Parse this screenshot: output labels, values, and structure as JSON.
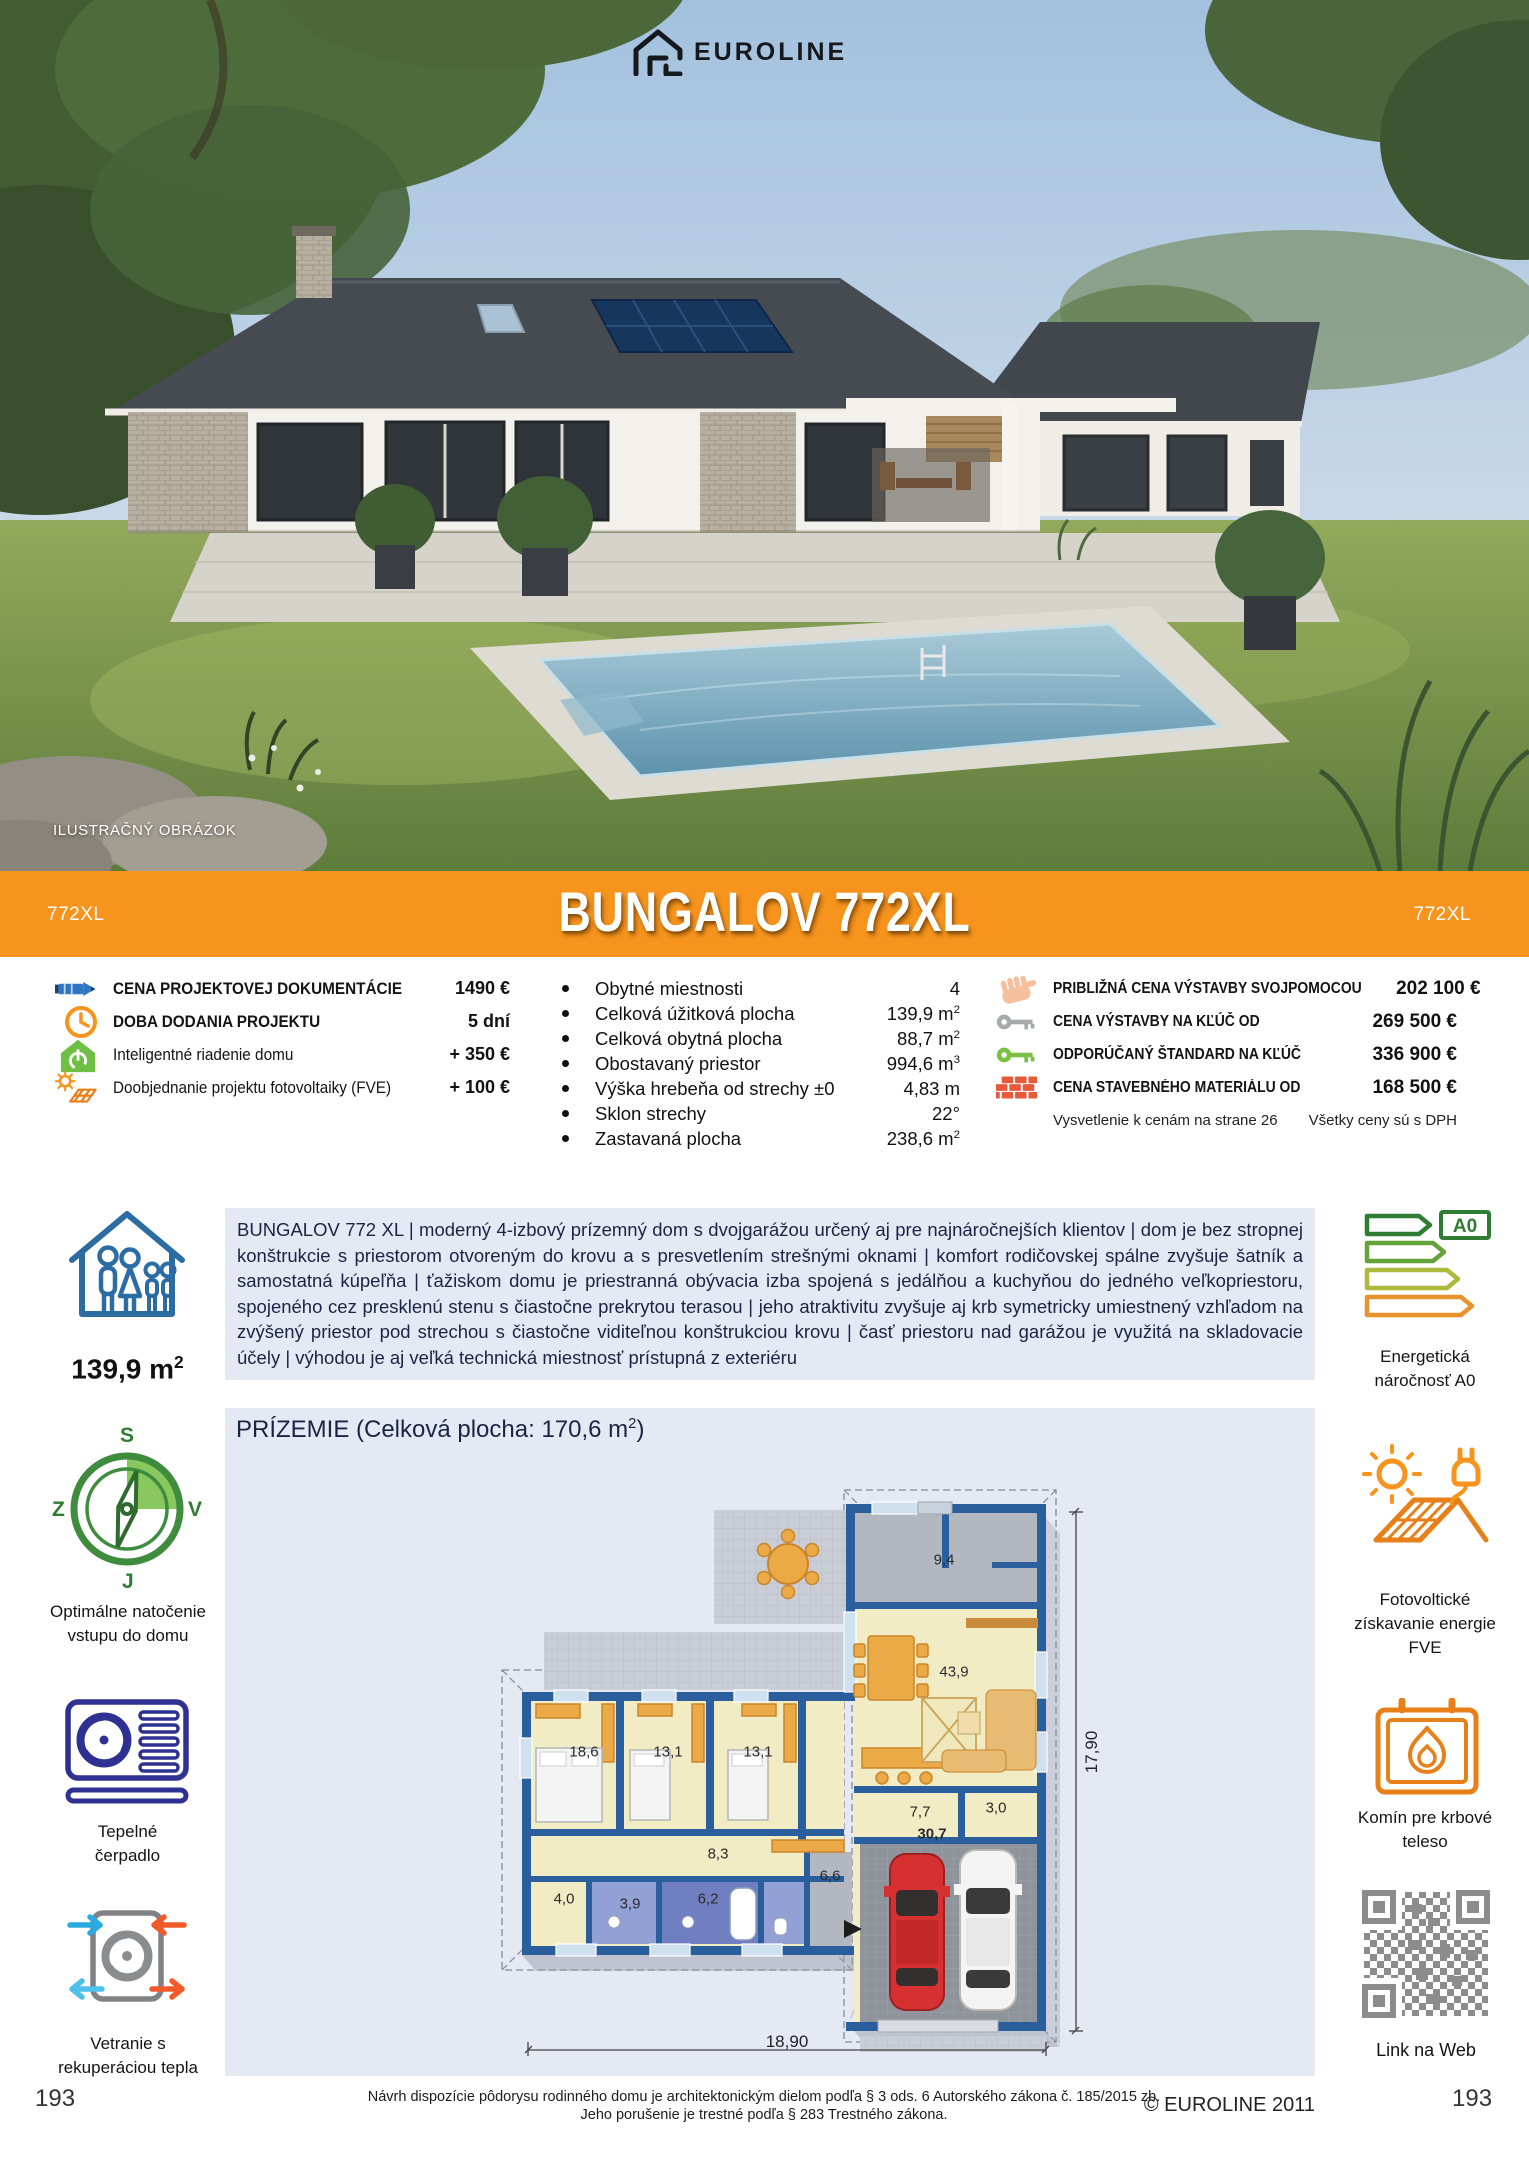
{
  "logo": {
    "brand": "EUROLINE"
  },
  "photo": {
    "caption": "ILUSTRAČNÝ OBRÁZOK"
  },
  "banner": {
    "code_left": "772XL",
    "title": "BUNGALOV 772XL",
    "code_right": "772XL",
    "bg": "#F7941D"
  },
  "pricing_left": {
    "rows": [
      {
        "icon": "pencil-icon",
        "label": "CENA PROJEKTOVEJ DOKUMENTÁCIE",
        "value": "1490 €"
      },
      {
        "icon": "clock-icon",
        "label": "DOBA DODANIA PROJEKTU",
        "value": "5 dní"
      },
      {
        "icon": "smart-home-icon",
        "label": "Inteligentné riadenie domu",
        "value": "+ 350 €"
      },
      {
        "icon": "solar-addon-icon",
        "label": "Doobjednanie projektu fotovoltaiky (FVE)",
        "value": "+ 100 €"
      }
    ]
  },
  "specs": {
    "rows": [
      {
        "label": "Obytné miestnosti",
        "num": "4",
        "sup": ""
      },
      {
        "label": "Celková úžitková plocha",
        "num": "139,9 m",
        "sup": "2"
      },
      {
        "label": "Celková obytná plocha",
        "num": "88,7 m",
        "sup": "2"
      },
      {
        "label": "Obostavaný priestor",
        "num": "994,6 m",
        "sup": "3"
      },
      {
        "label": "Výška hrebeňa od strechy ±0",
        "num": "4,83 m",
        "sup": ""
      },
      {
        "label": "Sklon strechy",
        "num": "22°",
        "sup": ""
      },
      {
        "label": "Zastavaná plocha",
        "num": "238,6 m",
        "sup": "2"
      }
    ]
  },
  "pricing_right": {
    "rows": [
      {
        "icon": "hand-icon",
        "label": "PRIBLIŽNÁ CENA VÝSTAVBY SVOJPOMOCOU",
        "value": "202 100 €"
      },
      {
        "icon": "key-gray-icon",
        "label": "CENA VÝSTAVBY NA KĽÚČ OD",
        "value": "269 500 €"
      },
      {
        "icon": "key-green-icon",
        "label": "ODPORÚČANÝ ŠTANDARD NA KĽÚČ",
        "value": "336 900 €"
      },
      {
        "icon": "bricks-icon",
        "label": "CENA STAVEBNÉHO MATERIÁLU OD",
        "value": "168 500 €"
      }
    ],
    "note_left": "Vysvetlenie k cenám na strane 26",
    "note_right": "Všetky ceny sú s DPH"
  },
  "description": "BUNGALOV 772 XL | moderný 4-izbový prízemný dom s dvojgarážou určený aj pre najnáročnejších klientov | dom je bez stropnej konštrukcie s priestorom otvoreným do krovu a s presvetlením strešnými oknami | komfort rodičovskej spálne zvyšuje šatník a samostatná kúpeľňa | ťažiskom domu je priestranná obývacia izba spojená s jedálňou a kuchyňou do jedného veľkopriestoru, spojeného cez presklenú stenu s čiastočne prekrytou terasou | jeho atraktivitu zvyšuje aj krb symetricky umiestnený vzhľadom na zvýšený priestor pod strechou s čiastočne viditeľnou konštrukciou krovu | časť priestoru nad garážou je využitá na skladovacie účely | výhodou je aj veľká technická miestnosť prístupná z exteriéru",
  "sidebar_left": {
    "area_num": "139,9 m",
    "area_sup": "2",
    "compass_n": "S",
    "compass_w": "Z",
    "compass_e": "V",
    "compass_s": "J",
    "compass_label_1": "Optimálne natočenie",
    "compass_label_2": "vstupu do domu",
    "heatpump_1": "Tepelné",
    "heatpump_2": "čerpadlo",
    "vent_1": "Vetranie s",
    "vent_2": "rekuperáciou tepla"
  },
  "sidebar_right": {
    "energy_badge": "A0",
    "energy_1": "Energetická",
    "energy_2": "náročnosť A0",
    "fve_1": "Fotovoltické",
    "fve_2": "získavanie energie",
    "fve_3": "FVE",
    "chimney_1": "Komín pre krbové",
    "chimney_2": "teleso",
    "qr_label": "Link na Web"
  },
  "plan": {
    "title_pre": "PRÍZEMIE (Celková plocha: 170,6 m",
    "title_sup": "2",
    "title_post": ")",
    "rooms": [
      {
        "v": "9,4"
      },
      {
        "v": "43,9"
      },
      {
        "v": "18,6"
      },
      {
        "v": "13,1"
      },
      {
        "v": "13,1"
      },
      {
        "v": "8,3"
      },
      {
        "v": "7,7"
      },
      {
        "v": "3,0"
      },
      {
        "v": "30,7"
      },
      {
        "v": "4,0"
      },
      {
        "v": "3,9"
      },
      {
        "v": "6,2"
      },
      {
        "v": "6,6"
      }
    ],
    "dim_w": "18,90",
    "dim_h": "17,90"
  },
  "footer": {
    "legal_1": "Návrh dispozície pôdorysu rodinného domu je architektonickým dielom podľa § 3 ods. 6 Autorského zákona č. 185/2015 zb.",
    "legal_2": "Jeho porušenie je trestné podľa § 283 Trestného zákona.",
    "copyright": "© EUROLINE 2011",
    "page_left": "193",
    "page_right": "193"
  }
}
